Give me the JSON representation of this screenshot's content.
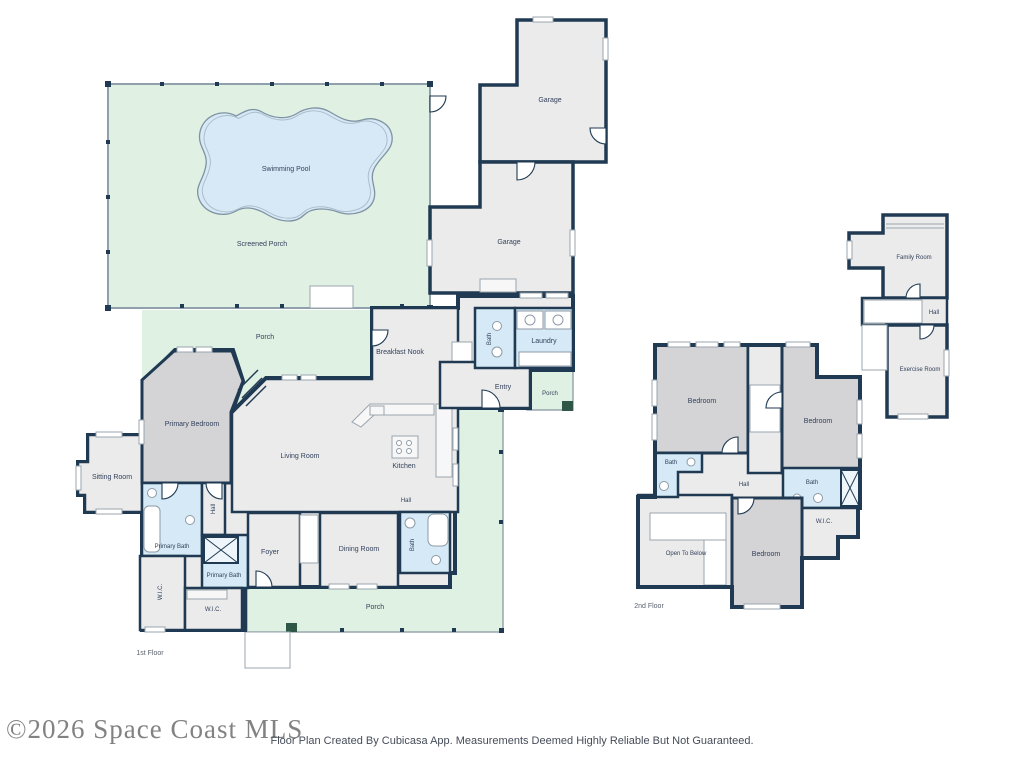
{
  "watermark": {
    "text": "©2026 Space Coast MLS"
  },
  "footer": {
    "disclaimer": "Floor Plan Created By Cubicasa App. Measurements Deemed Highly Reliable But Not Guaranteed."
  },
  "colors": {
    "wall": "#1f3a52",
    "room": "#ebebeb",
    "bedroom": "#d4d4d6",
    "bath": "#d5eaf6",
    "porch": "#def1e2",
    "screened_porch": "#e0f0e3",
    "pool": "#d7e9f7",
    "pool_edge": "#7f93a2",
    "post": "#2e5747",
    "label": "#33415c",
    "floor_label": "#5a626e",
    "watermark": "#757575",
    "footer_text": "#454c58"
  },
  "first_floor": {
    "floor_label": "1st Floor",
    "rooms": {
      "swimming_pool": "Swimming Pool",
      "screened_porch": "Screened Porch",
      "porch_upper": "Porch",
      "garage_upper": "Garage",
      "garage_lower": "Garage",
      "breakfast_nook": "Breakfast Nook",
      "bath": "Bath",
      "laundry": "Laundry",
      "entry": "Entry",
      "porch_entry": "Porch",
      "primary_bedroom": "Primary Bedroom",
      "living_room": "Living Room",
      "kitchen": "Kitchen",
      "hall_kitchen": "Hall",
      "sitting_room": "Sitting Room",
      "primary_bath": "Primary Bath",
      "hall_suite": "Hall",
      "primary_bath_2": "Primary Bath",
      "wic_1": "W.I.C.",
      "wic_2": "W.I.C.",
      "foyer": "Foyer",
      "dining_room": "Dining Room",
      "bath_dining": "Bath",
      "porch_lower": "Porch"
    }
  },
  "second_floor": {
    "floor_label": "2nd Floor",
    "rooms": {
      "bedroom_left": "Bedroom",
      "bedroom_right": "Bedroom",
      "bedroom_lower": "Bedroom",
      "bath_left": "Bath",
      "bath_right": "Bath",
      "hall": "Hall",
      "wic": "W.I.C.",
      "open_to_below": "Open To Below",
      "family_room": "Family Room",
      "hall_upper": "Hall",
      "exercise_room": "Exercise Room"
    }
  }
}
